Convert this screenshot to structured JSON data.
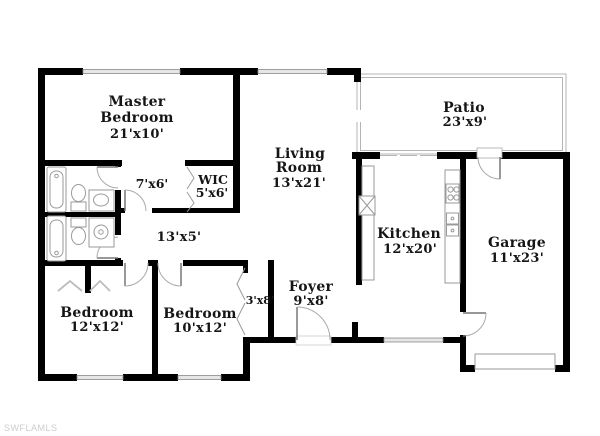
{
  "page": {
    "background": "#ffffff",
    "watermark": "SWFLAMLS"
  },
  "colors": {
    "wall": "#000000",
    "label_text": "#151515",
    "window_fill": "#e6e6e6",
    "thin_line": "#9a9a9a",
    "door_arc": "#aaaaaa",
    "watermark": "#cccccc"
  },
  "rooms": {
    "master_bedroom": {
      "line1": "Master",
      "line2": "Bedroom",
      "dim": "21'x10'"
    },
    "patio": {
      "line1": "Patio",
      "dim": "23'x9'"
    },
    "living_room": {
      "line1": "Living",
      "line2": "Room",
      "dim": "13'x21'"
    },
    "master_bath": {
      "dim": "7'x6'"
    },
    "wic": {
      "line1": "WIC",
      "dim": "5'x6'"
    },
    "hallway": {
      "dim": "13'x5'"
    },
    "kitchen": {
      "line1": "Kitchen",
      "dim": "12'x20'"
    },
    "garage": {
      "line1": "Garage",
      "dim": "11'x23'"
    },
    "foyer": {
      "line1": "Foyer",
      "dim": "9'x8'"
    },
    "hall_closet": {
      "dim": "3'x8'"
    },
    "bedroom_2": {
      "line1": "Bedroom",
      "dim": "12'x12'"
    },
    "bedroom_3": {
      "line1": "Bedroom",
      "dim": "10'x12'"
    }
  },
  "fixtures": [
    "bathtub",
    "toilet",
    "vanity-sink",
    "shower",
    "range-burners",
    "kitchen-sink",
    "refrigerator",
    "closet-rod",
    "bifold-door",
    "sliding-glass-door",
    "entry-door",
    "garage-vehicle-door",
    "window",
    "screened-patio"
  ]
}
